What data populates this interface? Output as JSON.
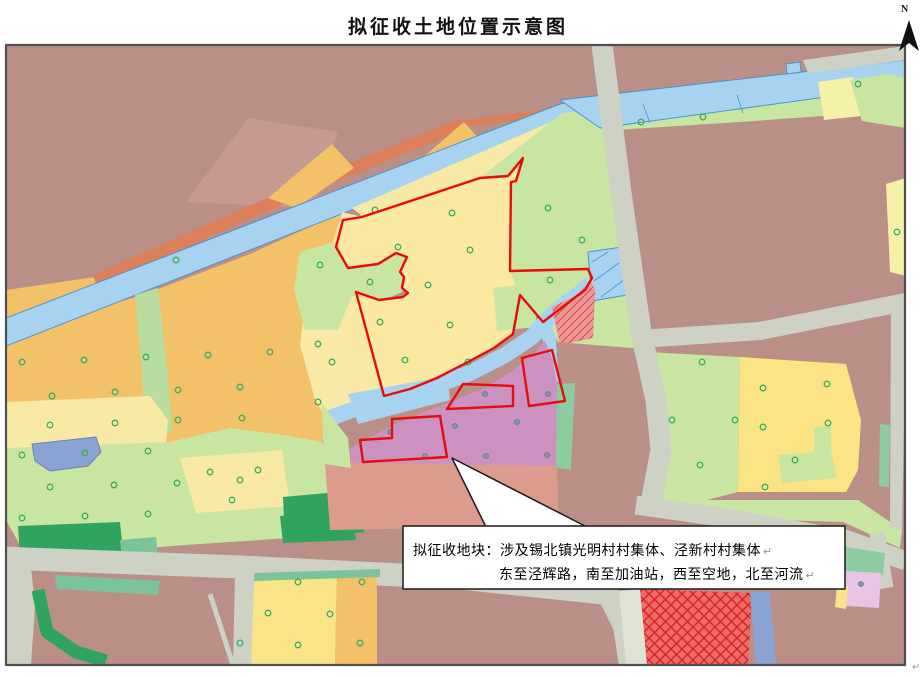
{
  "title": "拟征收土地位置示意图",
  "north_label": "N",
  "corner_mark": "↵",
  "callout": {
    "line1": "拟征收地块：涉及锡北镇光明村村集体、泾新村村集体",
    "line2": "东至泾辉路，南至加油站，西至空地，北至河流",
    "return_mark": "↵"
  },
  "colors": {
    "red_boundary": "#e80b0b",
    "river": "#a8d3f0",
    "road": "#cdd2c5",
    "mauve": "#ba8f88",
    "callout_border": "#1a1a1a"
  },
  "map": {
    "layers": [
      {
        "name": "base-mauve",
        "fill": "#ba8f88",
        "d": "M6,45 H905 V665 H6 Z"
      },
      {
        "name": "mauve-light-patch",
        "fill": "#c69a91",
        "d": "M186,202 L248,118 L338,132 L314,208 Z"
      },
      {
        "name": "orange-northwest-wedge",
        "fill": "#f2c168",
        "d": "M6,290 L95,277 L99,313 L6,322 Z"
      },
      {
        "name": "orange-west-farmland",
        "fill": "#f2c168",
        "d": "M6,332 L140,296 L250,254 L342,212 L350,230 L330,252 L305,300 L300,345 L315,400 L332,428 L322,442 L6,448 Z"
      },
      {
        "name": "salmon-road-band",
        "fill": "none",
        "stroke": "#dd7f5b",
        "sw": 12,
        "cap": "butt",
        "d": "M95,281 L300,190 L462,124"
      },
      {
        "name": "salmon-road-tail",
        "fill": "none",
        "stroke": "#dd7f5b",
        "sw": 7,
        "cap": "butt",
        "d": "M462,124 L598,106"
      },
      {
        "name": "orange-sliver-1",
        "fill": "#f2c168",
        "d": "M268,198 L332,144 L354,168 L296,208 Z"
      },
      {
        "name": "orange-sliver-2",
        "fill": "#f2c168",
        "d": "M420,160 L464,122 L480,140 L434,174 Z"
      },
      {
        "name": "green-north-bank",
        "fill": "#c8e5a2",
        "d": "M147,270 L252,228 L260,242 L156,282 Z"
      },
      {
        "name": "river-diagonal",
        "fill": "#a8d3f0",
        "stroke": "#4a93cf",
        "sw": 1,
        "d": "M6,318 L560,104 L602,96 L602,130 L565,126 L6,346 Z"
      },
      {
        "name": "paleyellow-northwest",
        "fill": "#f9e9a6",
        "d": "M352,208 L560,118 L566,136 L524,157 L508,175 L480,177 L362,216 Z"
      },
      {
        "name": "paleyellow-west-strip",
        "fill": "#f9e9a6",
        "d": "M342,212 L362,217 L343,220 L336,247 L356,292 L370,344 L384,396 L360,408 L332,428 L315,400 L300,345 L305,300 L330,252 Z"
      },
      {
        "name": "green-carveout-blob",
        "fill": "#c8e5a2",
        "d": "M300,252 L340,240 L362,250 L402,252 L410,270 L402,292 L380,302 L352,296 L338,330 L305,330 L294,290 Z"
      },
      {
        "name": "green-vertical-strip",
        "fill": "#b9dda0",
        "d": "M135,295 L158,288 L168,376 L172,432 L146,436 L142,376 Z"
      },
      {
        "name": "paleyellow-band-west",
        "fill": "#f9e9a6",
        "d": "M6,402 L150,396 L168,420 L166,445 L6,450 Z"
      },
      {
        "name": "lightgreen-southwest",
        "fill": "#c8e5a2",
        "d": "M6,448 L170,442 L230,428 L290,436 L322,442 L340,470 L335,530 L290,538 L185,545 L122,550 L20,545 L6,520 Z"
      },
      {
        "name": "paleyellow-parcel-sw",
        "fill": "#f9e9a6",
        "d": "M180,458 L282,450 L290,506 L196,513 Z"
      },
      {
        "name": "darkgreen-band-1",
        "fill": "#2fa35f",
        "d": "M18,526 L120,522 L123,552 L20,556 Z"
      },
      {
        "name": "darkgreen-band-2",
        "fill": "#2fa35f",
        "d": "M280,516 L352,512 L356,540 L283,543 Z"
      },
      {
        "name": "darkgreen-blob",
        "fill": "#2fa35f",
        "d": "M283,497 L360,490 L364,532 L285,540 Z"
      },
      {
        "name": "teal-square",
        "fill": "#7cc39a",
        "d": "M120,540 L156,537 L158,557 L122,559 Z"
      },
      {
        "name": "pond-southwest",
        "fill": "#8ba3d2",
        "stroke": "#6b80b8",
        "sw": 1,
        "d": "M32,444 L96,437 L101,452 L88,466 L50,471 L35,461 Z"
      },
      {
        "name": "green-block-east",
        "fill": "#c8e5a2",
        "d": "M480,178 L562,113 L600,109 L617,145 L634,255 L650,332 L646,350 L560,344 L545,324 L520,296 L480,242 Z"
      },
      {
        "name": "green-riverside-strip",
        "fill": "#c8e5a2",
        "d": "M565,117 L906,90 L906,110 L740,122 L600,131 Z"
      },
      {
        "name": "river-horizontal",
        "fill": "#a8d3f0",
        "stroke": "#4a93cf",
        "sw": 1,
        "d": "M560,100 L906,60 L906,86 L600,128 Z"
      },
      {
        "name": "river-tab-1",
        "fill": "#a8d3f0",
        "stroke": "#4a93cf",
        "sw": 1,
        "d": "M786,64 L800,62 L801,72 L787,74 Z"
      },
      {
        "name": "river-tab-2",
        "fill": "#a8d3f0",
        "stroke": "#4a93cf",
        "sw": 1,
        "d": "M810,59 L820,58 L821,67 L811,68 Z"
      },
      {
        "name": "river-weir-1",
        "fill": "none",
        "stroke": "#4a93cf",
        "sw": 0.8,
        "d": "M643,104 L650,123"
      },
      {
        "name": "river-weir-2",
        "fill": "none",
        "stroke": "#4a93cf",
        "sw": 0.8,
        "d": "M737,95 L743,113"
      },
      {
        "name": "gray-band-topright",
        "fill": "#cdd2c5",
        "d": "M803,60 L906,46 L906,60 L808,73 Z"
      },
      {
        "name": "paleyellow-wedge-topright",
        "fill": "#f5f1a8",
        "d": "M818,82 L853,77 L861,116 L824,120 Z"
      },
      {
        "name": "green-blob-topright",
        "fill": "#c8e5a2",
        "d": "M850,80 L886,74 L906,78 L906,128 L862,121 Z"
      },
      {
        "name": "lemon-strip-right",
        "fill": "#f5f1a8",
        "d": "M886,184 L906,178 L906,276 L890,272 Z"
      },
      {
        "name": "main-parcel-yellow",
        "fill": "#fbe9a1",
        "d": "M523,158 L516,181 L511,182 L510,271 L520,296 L513,334 L494,348 L466,363 L437,378 L410,389 L384,396 L370,344 L356,292 L379,300 L403,297 L408,293 L402,288 L404,277 L400,272 L407,257 L396,253 L378,264 L348,268 L336,247 L343,220 L362,217 L480,178 L508,176 Z"
      },
      {
        "name": "parcel-green-patch",
        "fill": "#c8e5a2",
        "d": "M493,288 L532,283 L537,327 L497,331 Z"
      },
      {
        "name": "pond-northeast",
        "fill": "#a8d3f0",
        "stroke": "#4a93cf",
        "sw": 1,
        "d": "M588,252 L622,247 L627,295 L592,301 Z"
      },
      {
        "name": "pond-ne-hatch1",
        "fill": "none",
        "stroke": "#4a93cf",
        "sw": 0.8,
        "d": "M592,262 L608,252"
      },
      {
        "name": "pond-ne-hatch2",
        "fill": "none",
        "stroke": "#4a93cf",
        "sw": 0.8,
        "d": "M594,281 L619,263"
      },
      {
        "name": "pond-ne-hatch3",
        "fill": "none",
        "stroke": "#4a93cf",
        "sw": 0.8,
        "d": "M601,297 L625,279"
      },
      {
        "name": "river-center",
        "fill": "none",
        "stroke": "#a8d3f0",
        "sw": 16,
        "cap": "butt",
        "d": "M330,418 L360,407 L420,391 L470,373 L505,355 L532,337 L548,319 L562,306 L580,293 L590,284"
      },
      {
        "name": "river-center-wide",
        "fill": "#a8d3f0",
        "d": "M348,394 L447,376 L450,400 L358,424 Z"
      },
      {
        "name": "river-center-branch",
        "fill": "none",
        "stroke": "#a8d3f0",
        "sw": 13,
        "cap": "butt",
        "d": "M543,320 L552,348 L556,382"
      },
      {
        "name": "purple-region",
        "fill": "#cb92c1",
        "d": "M350,448 L395,424 L445,404 L485,388 L512,371 L534,353 L545,341 L553,360 L557,385 L557,466 L352,470 Z"
      },
      {
        "name": "pink-hatched-parcel",
        "fill": "#ec9797",
        "d": "M552,307 L577,295 L591,281 L595,290 L593,338 L560,345 Z"
      },
      {
        "name": "pink-hatched-overlay",
        "fill": "url(#dhatch)",
        "d": "M552,307 L577,295 L591,281 L595,290 L593,338 L560,345 Z"
      },
      {
        "name": "mauve-block-center",
        "fill": "#ba8f88",
        "d": "M556,342 L646,349 L644,382 L559,384 Z"
      },
      {
        "name": "midgreen-strip-east-purple",
        "fill": "#8fcba0",
        "d": "M557,384 L575,383 L571,470 L556,468 Z"
      },
      {
        "name": "mauve-junction-wedge",
        "fill": "#ba8f88",
        "d": "M575,383 L644,383 L650,432 L652,500 L622,512 L577,470 Z"
      },
      {
        "name": "salmon-region-south",
        "fill": "#dd9b8d",
        "d": "M325,462 L557,466 L559,526 L330,530 Z"
      },
      {
        "name": "green-west-of-purple",
        "fill": "#c8e5a2",
        "d": "M322,404 L348,438 L351,468 L324,464 Z"
      },
      {
        "name": "lightgreen-east-region",
        "fill": "#c8e5a2",
        "d": "M648,352 L740,357 L738,492 L680,507 L656,502 L650,430 Z"
      },
      {
        "name": "yellow-east-parcel",
        "fill": "#fbe483",
        "d": "M740,357 L846,364 L861,420 L858,470 L846,492 L738,492 Z"
      },
      {
        "name": "green-inclusion-1",
        "fill": "#c8e5a2",
        "d": "M778,455 L831,451 L837,478 L782,483 Z"
      },
      {
        "name": "green-inclusion-2",
        "fill": "#c8e5a2",
        "d": "M814,427 L831,426 L831,452 L814,453 Z"
      },
      {
        "name": "green-under-strip",
        "fill": "#c8e5a2",
        "d": "M680,500 L858,500 L902,530 L900,548 L843,522 L680,517 Z"
      },
      {
        "name": "green-bar-right",
        "fill": "#8fcba0",
        "d": "M880,424 L890,425 L889,487 L879,486 Z"
      },
      {
        "name": "road-right-vertical",
        "fill": "#cdd2c5",
        "d": "M889,298 L906,295 L906,312 L902,530 L890,528 L891,312 Z"
      },
      {
        "name": "road-horizontal-east",
        "fill": "none",
        "stroke": "#cdd2c5",
        "sw": 18,
        "cap": "butt",
        "d": "M640,339 L760,331 L906,302"
      },
      {
        "name": "road-vertical-main",
        "fill": "none",
        "stroke": "#cdd2c5",
        "sw": 21,
        "cap": "butt",
        "d": "M602,45 L622,200 L641,332 L656,400 L661,450 L650,508"
      },
      {
        "name": "road-southeast",
        "fill": "none",
        "stroke": "#cdd2c5",
        "sw": 19,
        "cap": "butt",
        "d": "M636,505 L720,517 L845,539 L906,561"
      },
      {
        "name": "road-bottom-main",
        "fill": "none",
        "stroke": "#cdd2c5",
        "sw": 23,
        "cap": "butt",
        "d": "M0,558 L240,567 L460,578 L612,594"
      },
      {
        "name": "road-bottom-south-turn",
        "fill": "none",
        "stroke": "#cdd2c5",
        "sw": 22,
        "cap": "butt",
        "d": "M606,590 L624,626 L630,665"
      },
      {
        "name": "road-spur-right",
        "fill": "none",
        "stroke": "#cdd2c5",
        "sw": 15,
        "cap": "butt",
        "d": "M877,533 L886,588"
      },
      {
        "name": "road-left-curve",
        "fill": "#cdd2c5",
        "d": "M6,556 L30,558 L35,605 L31,665 L6,665 Z"
      },
      {
        "name": "road-thin-diagonal",
        "fill": "none",
        "stroke": "#cdd2c5",
        "sw": 5,
        "cap": "butt",
        "d": "M210,594 L233,665"
      },
      {
        "name": "teal-strip-below-road",
        "fill": "#7cc39a",
        "d": "M55,575 L160,581 L158,595 L57,589 Z"
      },
      {
        "name": "darkgreen-corner-band",
        "fill": "none",
        "stroke": "#2fa35f",
        "sw": 13,
        "cap": "butt",
        "d": "M38,590 L47,632 L76,652 L106,661"
      },
      {
        "name": "gray-diag-bottom-parcel",
        "fill": "#cdd2c5",
        "d": "M235,576 L254,578 L251,665 L233,665 Z"
      },
      {
        "name": "paleyellow-bottom-parcel",
        "fill": "#fbe487",
        "d": "M254,578 L337,574 L335,665 L251,665 Z"
      },
      {
        "name": "orange-bottom-parcel",
        "fill": "#f2c168",
        "d": "M337,574 L377,572 L377,665 L335,665 Z"
      },
      {
        "name": "teal-strip-bottom-parcel",
        "fill": "#7cc39a",
        "d": "M254,573 L380,569 L380,577 L254,581 Z"
      },
      {
        "name": "crosshatch-parcel",
        "fill": "#ec6a67",
        "d": "M638,589 L752,593 L748,665 L646,665 Z"
      },
      {
        "name": "crosshatch-overlay",
        "fill": "url(#xhatch)",
        "d": "M638,589 L752,593 L748,665 L646,665 Z"
      },
      {
        "name": "graylight-strip",
        "fill": "#dfe3d6",
        "d": "M619,591 L640,589 L647,665 L626,665 Z"
      },
      {
        "name": "periwinkle-band",
        "fill": "#8ba3d2",
        "d": "M750,593 L770,591 L776,665 L756,665 Z"
      },
      {
        "name": "green-strip-bottomright",
        "fill": "#8fcba0",
        "d": "M840,546 L885,553 L883,575 L843,571 Z"
      },
      {
        "name": "pink-parcel-bottomright",
        "fill": "#e8c4e4",
        "d": "M845,571 L881,573 L879,608 L846,606 Z"
      },
      {
        "name": "yellow-wedge-bottomright",
        "fill": "#fbe487",
        "d": "M837,585 L848,586 L846,609 L835,607 Z"
      }
    ],
    "tree_markers": [
      [
        22,
        362
      ],
      [
        84,
        360
      ],
      [
        146,
        357
      ],
      [
        208,
        355
      ],
      [
        270,
        352
      ],
      [
        318,
        344
      ],
      [
        52,
        396
      ],
      [
        115,
        392
      ],
      [
        178,
        390
      ],
      [
        240,
        387
      ],
      [
        50,
        425
      ],
      [
        115,
        423
      ],
      [
        178,
        420
      ],
      [
        242,
        418
      ],
      [
        22,
        455
      ],
      [
        85,
        453
      ],
      [
        148,
        451
      ],
      [
        210,
        472
      ],
      [
        258,
        470
      ],
      [
        232,
        500
      ],
      [
        50,
        487
      ],
      [
        114,
        485
      ],
      [
        177,
        483
      ],
      [
        240,
        480
      ],
      [
        22,
        518
      ],
      [
        85,
        516
      ],
      [
        148,
        514
      ],
      [
        176,
        260
      ],
      [
        320,
        265
      ],
      [
        332,
        362
      ],
      [
        318,
        402
      ],
      [
        370,
        282
      ],
      [
        375,
        210
      ],
      [
        452,
        213
      ],
      [
        398,
        247
      ],
      [
        470,
        250
      ],
      [
        428,
        285
      ],
      [
        380,
        322
      ],
      [
        450,
        325
      ],
      [
        405,
        360
      ],
      [
        468,
        362
      ],
      [
        548,
        208
      ],
      [
        582,
        240
      ],
      [
        550,
        280
      ],
      [
        641,
        122
      ],
      [
        703,
        117
      ],
      [
        858,
        84
      ],
      [
        702,
        362
      ],
      [
        672,
        420
      ],
      [
        735,
        420
      ],
      [
        700,
        465
      ],
      [
        763,
        388
      ],
      [
        827,
        384
      ],
      [
        763,
        427
      ],
      [
        828,
        423
      ],
      [
        795,
        460
      ],
      [
        765,
        487
      ],
      [
        897,
        232
      ],
      [
        298,
        582
      ],
      [
        268,
        613
      ],
      [
        330,
        614
      ],
      [
        240,
        643
      ],
      [
        298,
        645
      ],
      [
        362,
        582
      ],
      [
        360,
        643
      ]
    ],
    "dot_markers": [
      [
        485,
        394
      ],
      [
        548,
        394
      ],
      [
        455,
        426
      ],
      [
        517,
        422
      ],
      [
        425,
        456
      ],
      [
        486,
        456
      ],
      [
        547,
        455
      ],
      [
        390,
        432
      ],
      [
        861,
        584
      ]
    ],
    "red_parcels": [
      {
        "name": "expropriation-boundary-main",
        "d": "M523,158 L516,181 L511,182 L510,271 L588,269 L592,278 L585,290 L573,299 L543,322 L520,295 L513,334 L494,348 L466,363 L437,378 L410,389 L384,396 L370,344 L356,292 L379,300 L403,297 L408,293 L402,288 L404,277 L400,272 L407,257 L396,253 L378,264 L348,268 L336,247 L343,220 L362,217 L480,178 L508,176 Z"
      },
      {
        "name": "expropriation-boundary-south-left",
        "d": "M392,419 L440,416 L447,457 L363,462 L360,440 L392,438 Z"
      },
      {
        "name": "expropriation-boundary-south-mid",
        "d": "M447,409 L463,384 L513,386 L513,406 Z"
      },
      {
        "name": "expropriation-boundary-south-right",
        "d": "M522,358 L552,350 L565,401 L529,406 Z"
      }
    ],
    "overlays": [
      {
        "name": "callout-pointer",
        "fill": "#ffffff",
        "stroke": "#1a1a1a",
        "sw": 1.5,
        "d": "M452,458 L585,526 L486,527 Z"
      },
      {
        "name": "callout-box",
        "fill": "#ffffff",
        "stroke": "#1a1a1a",
        "sw": 1.5,
        "d": "M403,526 H845 V589 H403 Z"
      },
      {
        "name": "map-border",
        "fill": "none",
        "stroke": "#4f4f4f",
        "sw": 2.2,
        "d": "M6,45 H905 V665 H6 Z"
      },
      {
        "name": "north-arrow",
        "fill": "#111111",
        "d": "M909,20 L899,51 L909,43 L919,51 Z"
      }
    ]
  }
}
